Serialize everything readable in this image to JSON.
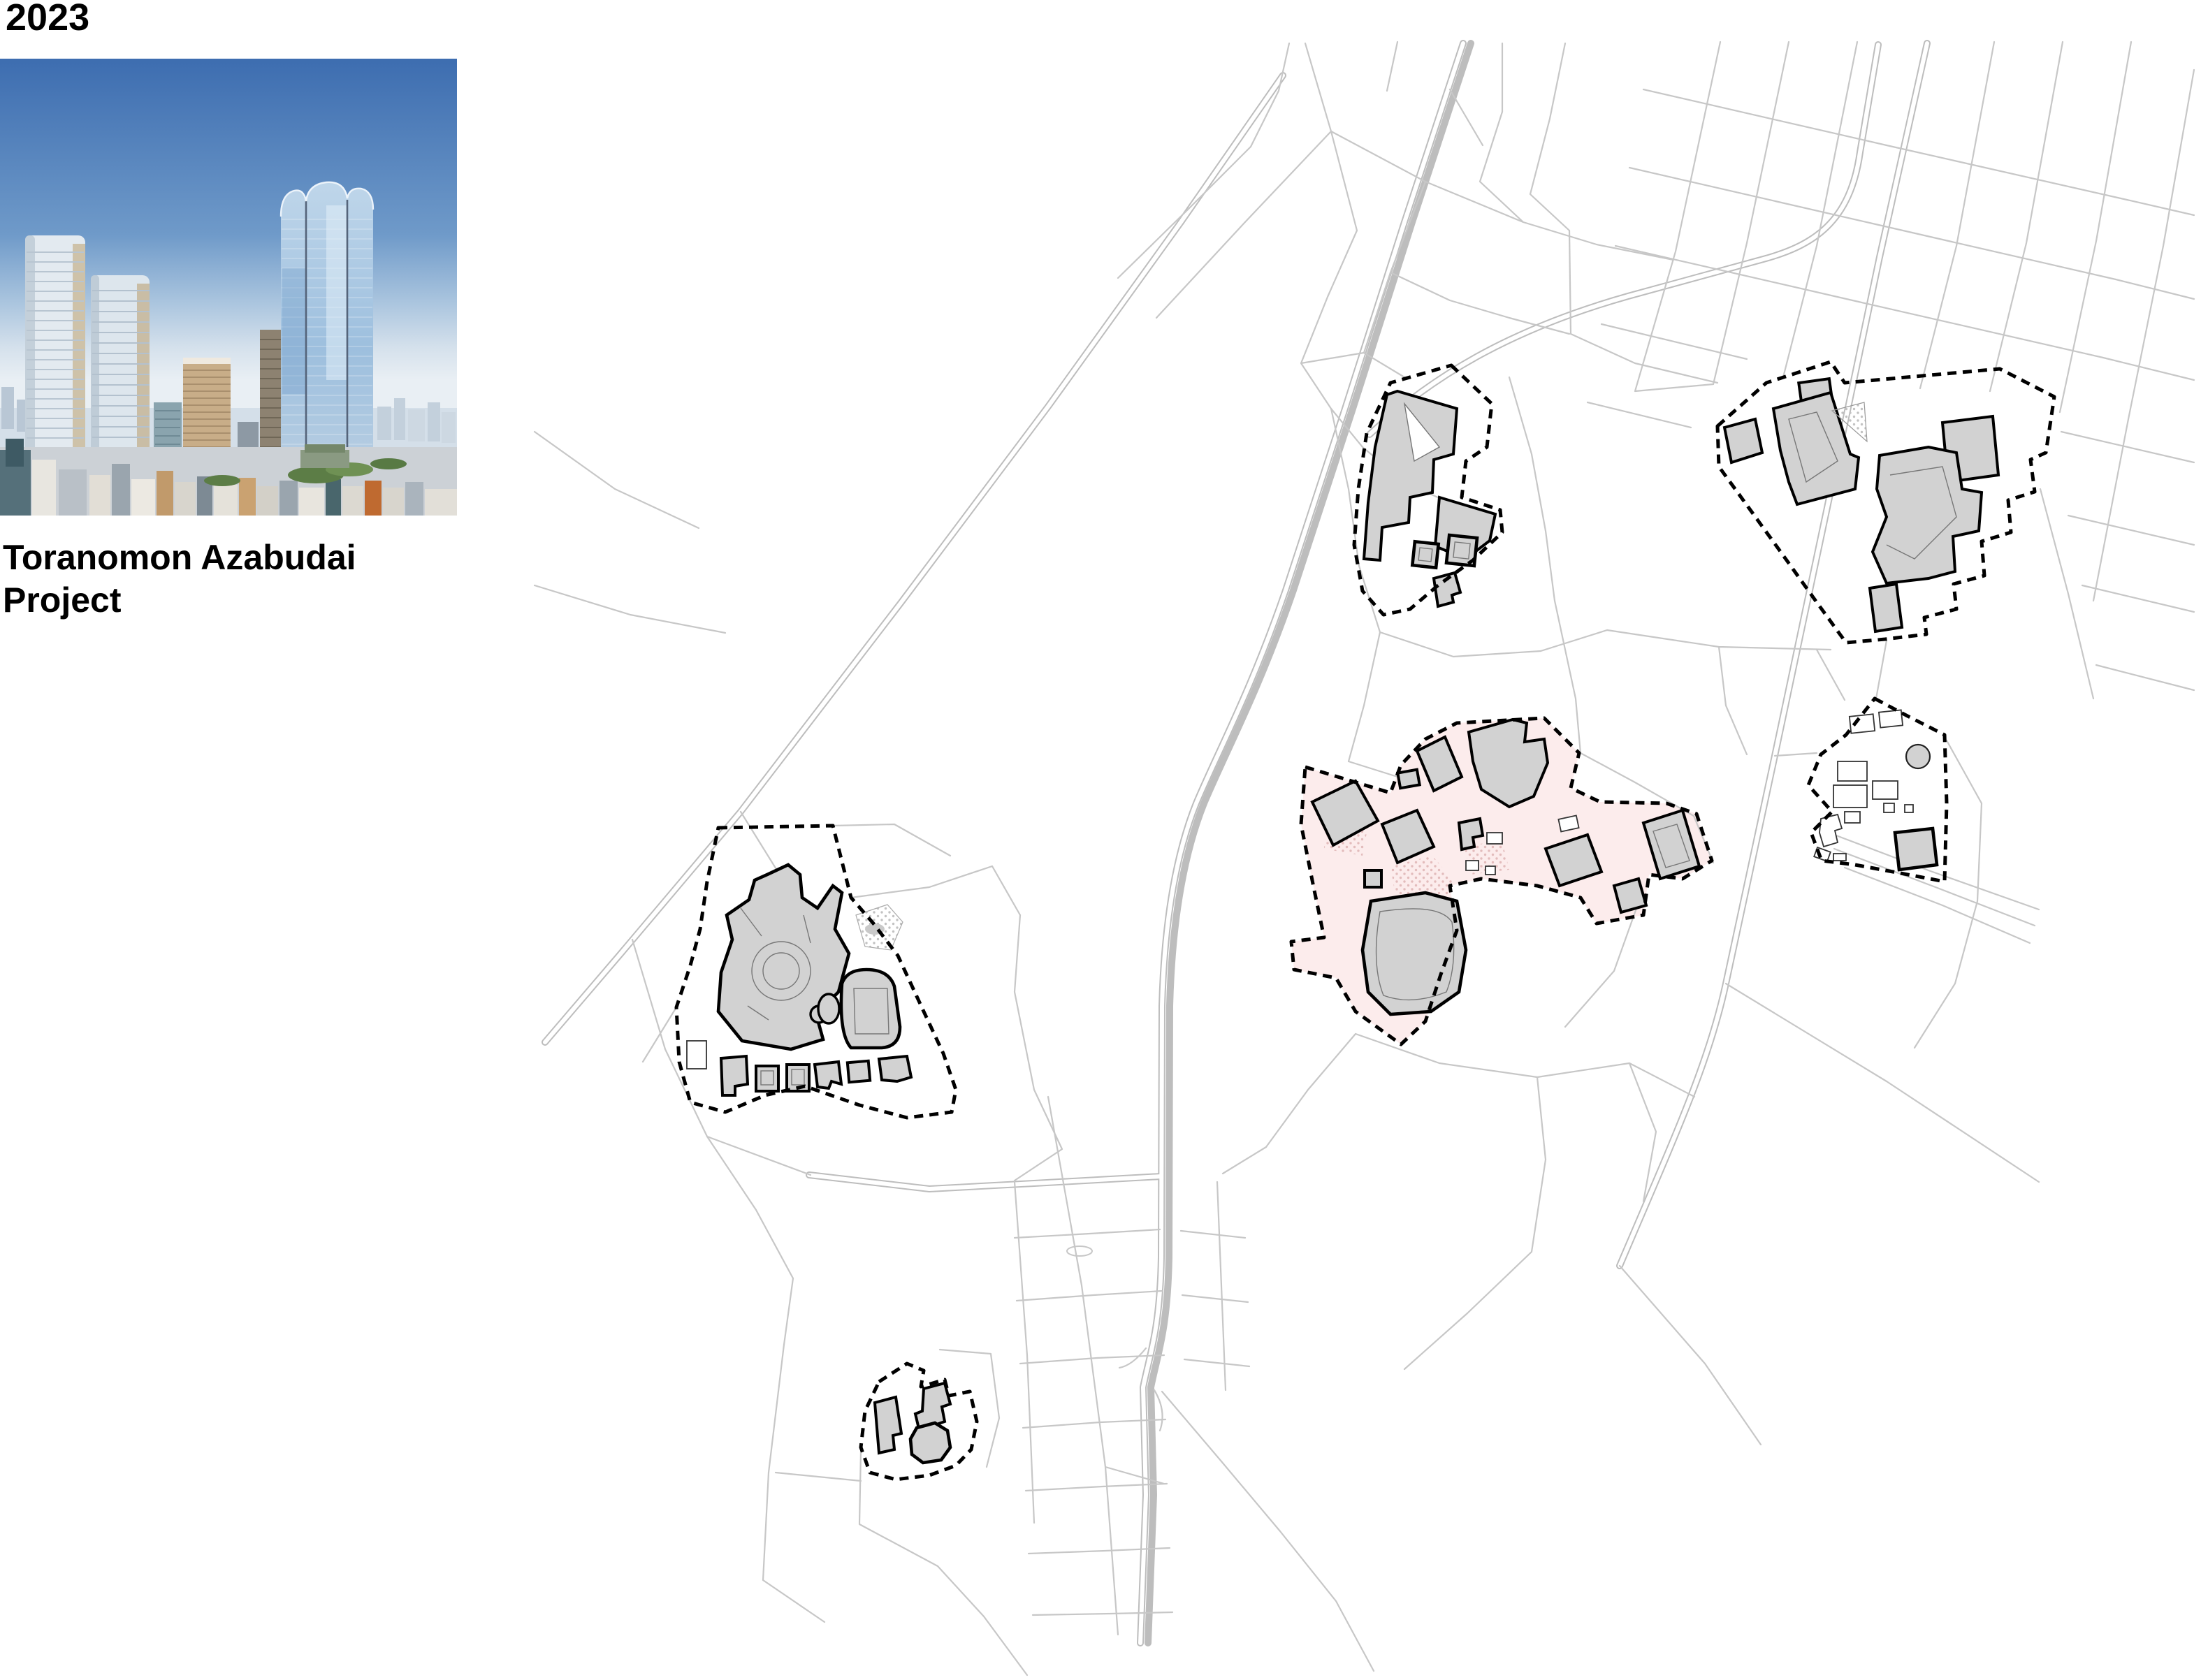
{
  "year_label": "2023",
  "caption": {
    "line1": "Toranomon Azabudai",
    "line2": "Project"
  },
  "photo": {
    "subject": "Aerial rendering of Tokyo skyline with the Toranomon Azabudai Project towers",
    "sky_top_color": "#3d6db0",
    "sky_horizon_color": "#e9eff4"
  },
  "map": {
    "subject": "Street map of the Toranomon / Azabudai area with redevelopment district outlines",
    "street_color": "#c7c7c7",
    "major_road_casing_color": "#bdbdbd",
    "district_outline_color": "#000000",
    "district_outline_style": "dashed",
    "building_fill": "#d2d2d2",
    "building_stroke": "#000000",
    "highlight_fill": "#fcecec",
    "highlight_dot_color": "#e3bcbc",
    "district_count": 6,
    "highlighted_district": "Toranomon Azabudai Project site (center, pink)"
  }
}
